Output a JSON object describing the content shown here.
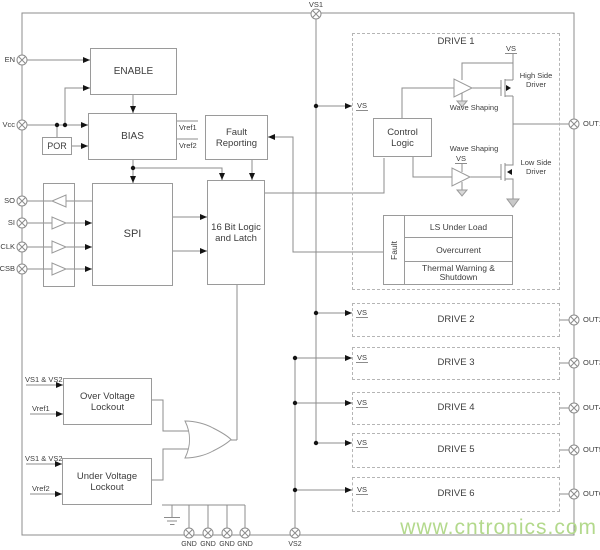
{
  "chip": {
    "watermark": "www.cntronics.com",
    "pins": {
      "en": "EN",
      "vcc": "Vcc",
      "so": "SO",
      "si": "SI",
      "sclk": "SCLK",
      "csb": "CSB",
      "vs1": "VS1",
      "vs2": "VS2",
      "gnd": "GND",
      "out1": "OUT1",
      "out2": "OUT2",
      "out3": "OUT3",
      "out4": "OUT4",
      "out5": "OUT5",
      "out6": "OUT6"
    },
    "blocks": {
      "enable": "ENABLE",
      "bias": "BIAS",
      "por": "POR",
      "fault_reporting_1": "Fault",
      "fault_reporting_2": "Reporting",
      "spi": "SPI",
      "logic_1": "16 Bit Logic",
      "logic_2": "and Latch",
      "control_1": "Control",
      "control_2": "Logic",
      "ovl_1": "Over Voltage",
      "ovl_2": "Lockout",
      "uvl_1": "Under Voltage",
      "uvl_2": "Lockout",
      "drive1": "DRIVE 1",
      "drive2": "DRIVE 2",
      "drive3": "DRIVE 3",
      "drive4": "DRIVE 4",
      "drive5": "DRIVE 5",
      "drive6": "DRIVE 6",
      "fault_vertical": "Fault",
      "fault_row1": "LS Under Load",
      "fault_row2": "Overcurrent",
      "fault_row3a": "Thermal Warning &",
      "fault_row3b": "Shutdown"
    },
    "labels": {
      "vs": "VS",
      "vref1": "Vref1",
      "vref2": "Vref2",
      "vs1_vs2": "VS1 & VS2",
      "wave_shaping": "Wave Shaping",
      "high_side_1": "High Side",
      "high_side_2": "Driver",
      "low_side_1": "Low Side",
      "low_side_2": "Driver"
    },
    "colors": {
      "wire": "#8c8c8c",
      "box_border": "#9a9a9a",
      "dashed_border": "#b5b5b5",
      "text": "#3d3d3d",
      "watermark": "#b3d98c"
    }
  }
}
